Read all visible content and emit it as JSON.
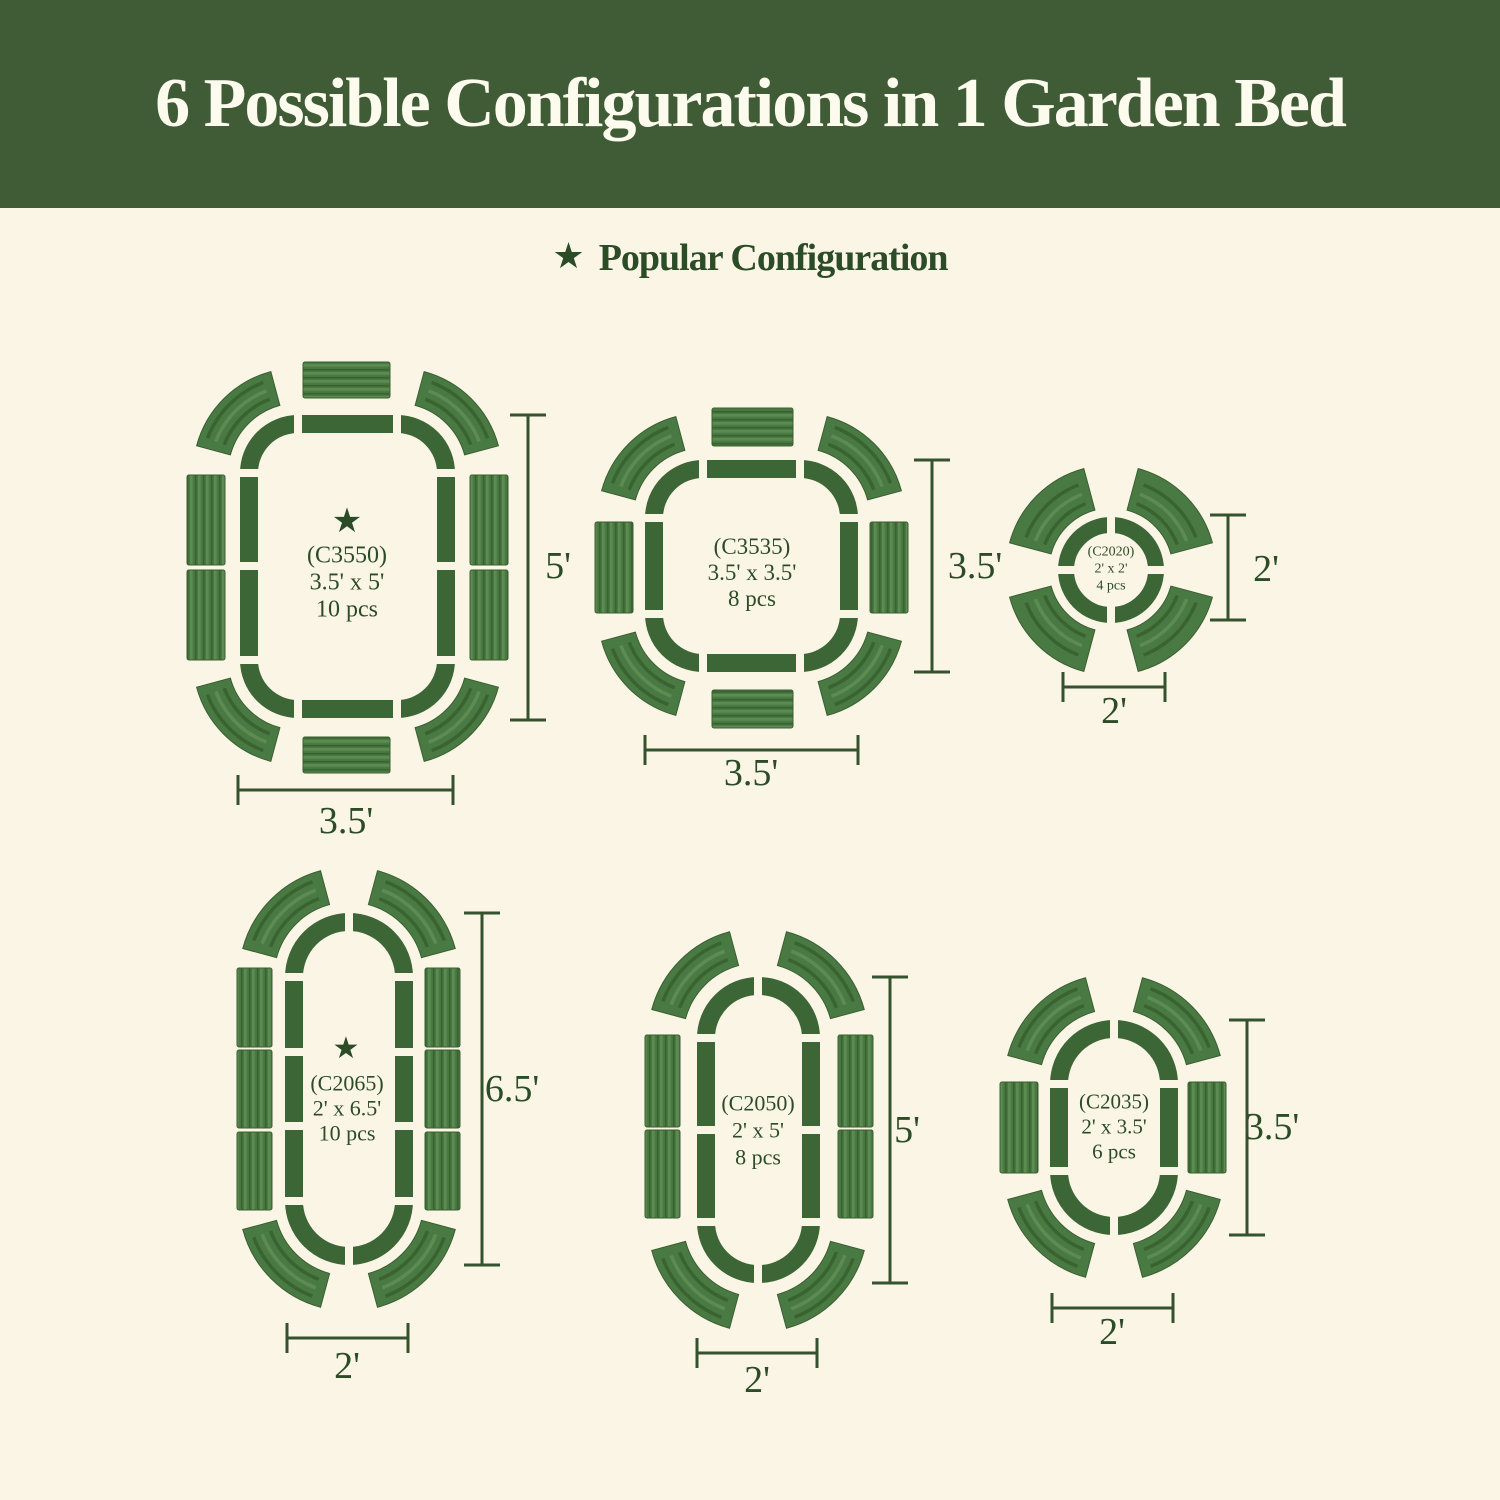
{
  "header": {
    "title": "6 Possible Configurations in 1 Garden Bed"
  },
  "legend": {
    "star": "★",
    "label": "Popular Configuration"
  },
  "configs": [
    {
      "code": "(C3550)",
      "size": "3.5' x 5'",
      "pcs": "10 pcs",
      "pieces": 10,
      "popular": true,
      "star": "★",
      "dim_v": "5'",
      "dim_h": "3.5'"
    },
    {
      "code": "(C3535)",
      "size": "3.5' x 3.5'",
      "pcs": "8 pcs",
      "pieces": 8,
      "popular": false,
      "dim_v": "3.5'",
      "dim_h": "3.5'"
    },
    {
      "code": "(C2020)",
      "size": "2' x 2'",
      "pcs": "4 pcs",
      "pieces": 4,
      "popular": false,
      "dim_v": "2'",
      "dim_h": "2'"
    },
    {
      "code": "(C2065)",
      "size": "2' x 6.5'",
      "pcs": "10 pcs",
      "pieces": 10,
      "popular": true,
      "star": "★",
      "dim_v": "6.5'",
      "dim_h": "2'"
    },
    {
      "code": "(C2050)",
      "size": "2' x 5'",
      "pcs": "8 pcs",
      "pieces": 8,
      "popular": false,
      "dim_v": "5'",
      "dim_h": "2'"
    },
    {
      "code": "(C2035)",
      "size": "2' x 3.5'",
      "pcs": "6 pcs",
      "pieces": 6,
      "popular": false,
      "dim_v": "3.5'",
      "dim_h": "2'"
    }
  ],
  "colors": {
    "bg": "#fbf5e5",
    "banner": "#3f5c37",
    "bannerText": "#fdfaee",
    "text": "#2c4c28",
    "outline": "#3d6636",
    "panelBase": "#4a7a43",
    "ridgeDark": "#3a642f",
    "ridgeLight": "#5c8c52",
    "panelEdge": "#3a5f31",
    "dim": "#33522d"
  }
}
